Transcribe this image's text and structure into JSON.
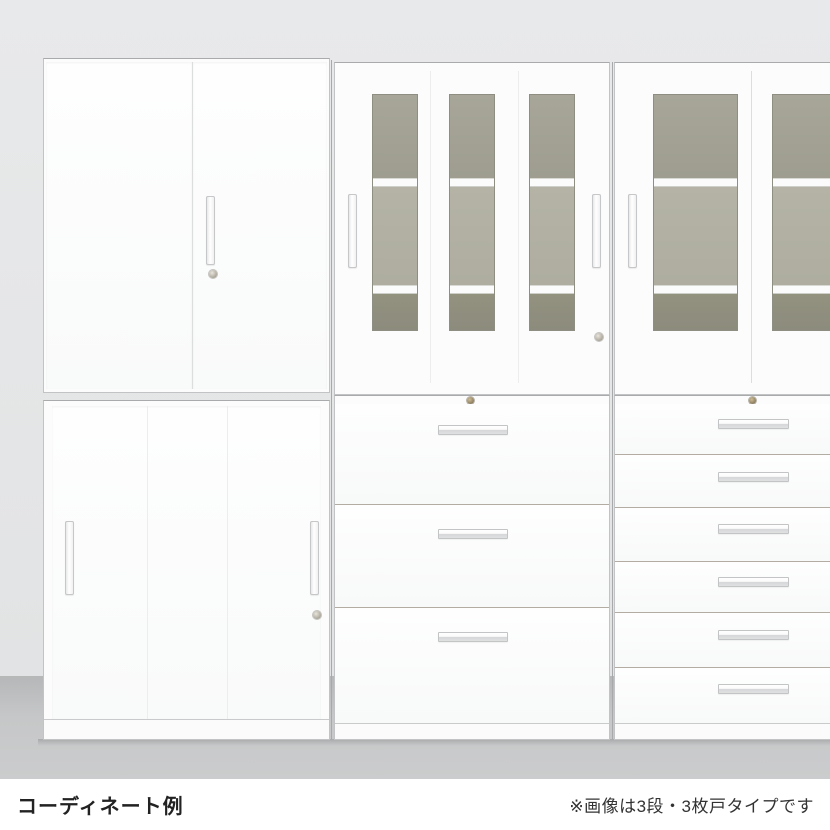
{
  "caption": {
    "title": "コーディネート例",
    "note": "※画像は3段・3枚戸タイプです"
  },
  "scene": {
    "description": "White office storage cabinet wall coordination example, studio product photo",
    "units": [
      {
        "id": "left-top",
        "type": "double-hinged-door-cabinet",
        "doors": 2,
        "handles": 1,
        "lock": true
      },
      {
        "id": "left-bottom",
        "type": "sliding-door-cabinet",
        "doors": 2,
        "handles": 2,
        "lock": true
      },
      {
        "id": "middle-top",
        "type": "glass-sliding-door-cabinet",
        "glass_windows": 3,
        "shelves_visible": 2,
        "handles": 2,
        "lock": true
      },
      {
        "id": "middle-bottom",
        "type": "lateral-drawer-cabinet",
        "drawers": 3,
        "lock": true
      },
      {
        "id": "right-top",
        "type": "glass-sliding-door-cabinet",
        "glass_windows": 2,
        "shelves_visible": 2,
        "handles": 1,
        "lock": false
      },
      {
        "id": "right-bottom",
        "type": "shallow-drawer-cabinet",
        "drawers": 6,
        "lock": true
      }
    ]
  },
  "colors": {
    "wall": "#e5e6e7",
    "floor": "#c0c1c2",
    "cabinet": "#fcfcfd",
    "unit_outline": "#b9babb",
    "glass_top_pane": "#a3a295",
    "glass_middle_pane": "#b2b1a3",
    "glass_bottom_pane": "#908f81",
    "handle_metal": "#d9dadb",
    "lock_brass": "#9a8a6a",
    "caption_text": "#222222"
  }
}
